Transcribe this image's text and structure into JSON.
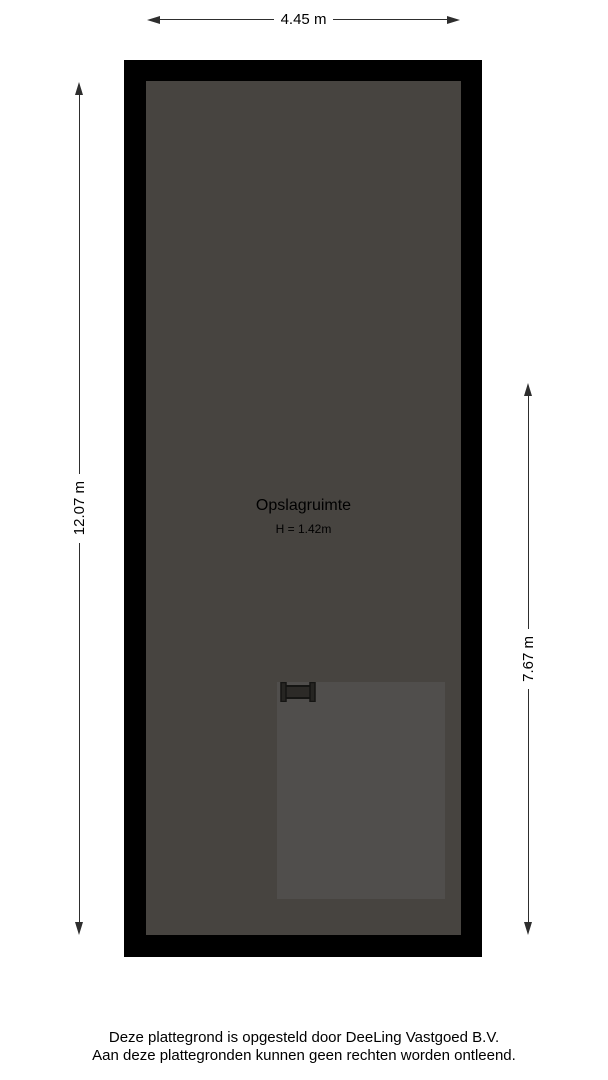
{
  "colors": {
    "background": "#ffffff",
    "wall": "#000000",
    "floor": "#474440",
    "inner_area": "#504e4c",
    "dimension": "#2e2e2e",
    "text": "#000000"
  },
  "dimensions": {
    "top_width": "4.45 m",
    "left_height": "12.07 m",
    "right_height": "7.67 m"
  },
  "room": {
    "name": "Opslagruimte",
    "ceiling_height": "H = 1.42m"
  },
  "footer": {
    "line1": "Deze plattegrond is opgesteld door DeeLing Vastgoed B.V.",
    "line2": "Aan deze plattegronden kunnen geen rechten worden ontleend."
  }
}
